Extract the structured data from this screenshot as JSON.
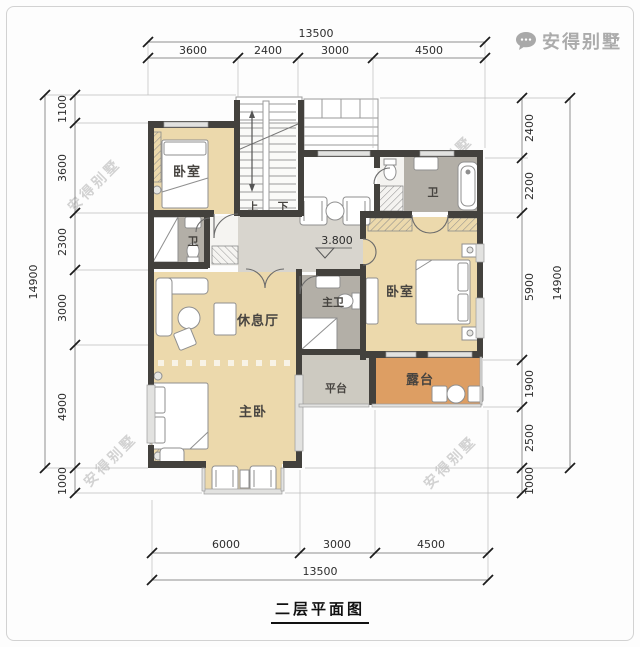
{
  "title": "二层平面图",
  "brand": {
    "name": "安得别墅",
    "icon": "chat-bubble-icon"
  },
  "watermark": {
    "text": "安得别墅"
  },
  "level_annotation": "3.800",
  "rooms": {
    "bedroom_top_left": "卧室",
    "bath_top_left": "卫",
    "bath_top_right": "卫",
    "lounge": "休息厅",
    "master_bedroom": "主卧",
    "master_bath": "主卫",
    "bedroom_right": "卧室",
    "platform": "平台",
    "terrace": "露台"
  },
  "stairs": {
    "up": "上",
    "down": "下"
  },
  "dimensions": {
    "top": {
      "total": "13500",
      "segments": [
        "3600",
        "2400",
        "3000",
        "4500"
      ]
    },
    "bottom": {
      "total": "13500",
      "segments": [
        "6000",
        "3000",
        "4500"
      ]
    },
    "left": {
      "total": "14900",
      "segments": [
        "1100",
        "3600",
        "2300",
        "3000",
        "4900",
        "1000"
      ]
    },
    "right": {
      "total": "14900",
      "segments": [
        "2400",
        "2200",
        "5900",
        "1900",
        "2500",
        "1000"
      ]
    }
  },
  "colors": {
    "floor_room": "#ecd9ac",
    "floor_bath": "#b3afa7",
    "floor_hall": "#d8d5ce",
    "floor_platform": "#cdcac1",
    "floor_terrace": "#dd9e63",
    "wall": "#43413d",
    "dimension_line": "#8f8f8f",
    "watermark_gray": "#8c8c8c"
  }
}
